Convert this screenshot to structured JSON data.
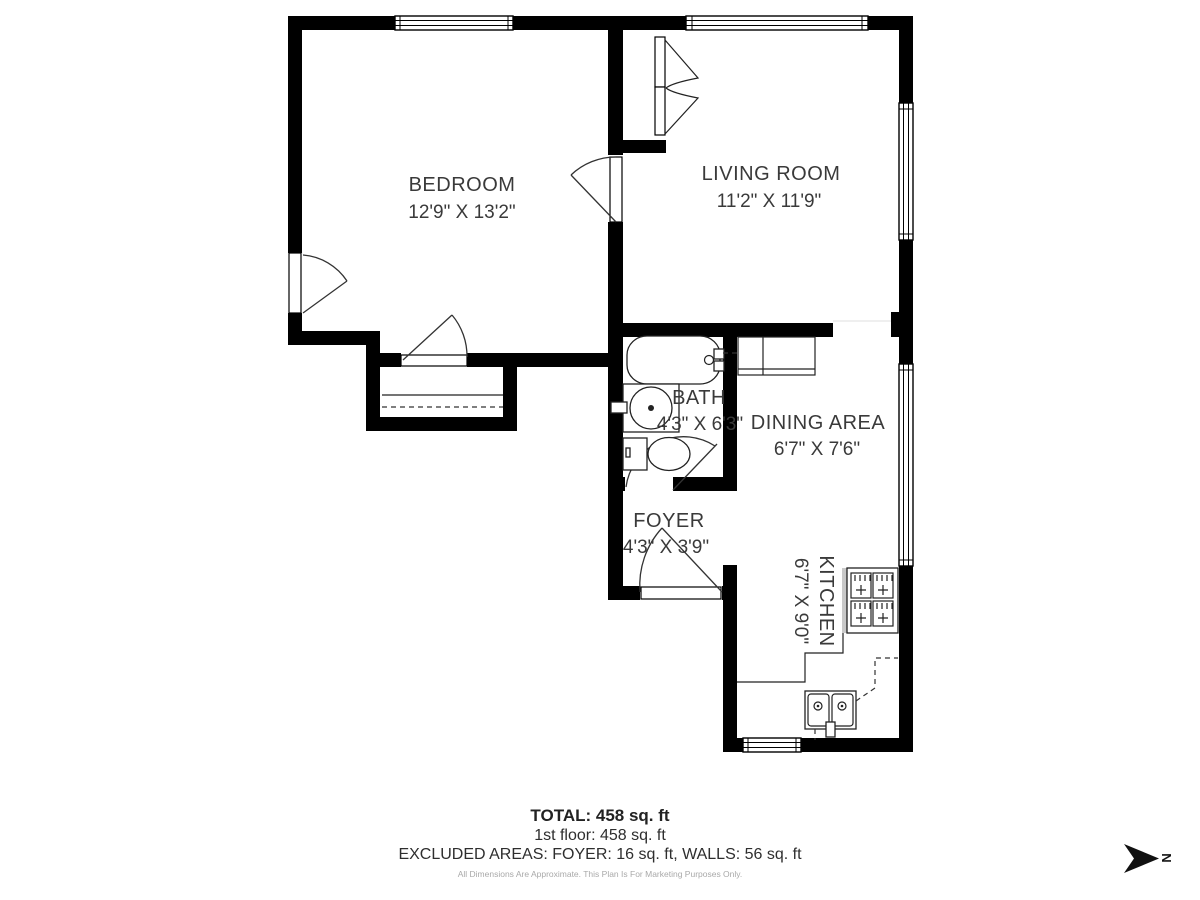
{
  "plan": {
    "rooms": {
      "bedroom": {
        "name": "BEDROOM",
        "dims": "12'9\" X 13'2\""
      },
      "living_room": {
        "name": "LIVING ROOM",
        "dims": "11'2\" X 11'9\""
      },
      "bath": {
        "name": "BATH",
        "dims": "4'3\" X 6'3\""
      },
      "dining": {
        "name": "DINING AREA",
        "dims": "6'7\" X 7'6\""
      },
      "foyer": {
        "name": "FOYER",
        "dims": "4'3\" X 3'9\""
      },
      "kitchen": {
        "name": "KITCHEN",
        "dims": "6'7\" X 9'0\""
      }
    },
    "north_label": "N"
  },
  "summary": {
    "total": "TOTAL: 458 sq. ft",
    "first_floor": "1st floor: 458 sq. ft",
    "excluded": "EXCLUDED AREAS: FOYER: 16 sq. ft, WALLS: 56 sq. ft",
    "disclaimer": "All Dimensions Are Approximate. This Plan Is For Marketing Purposes Only."
  },
  "colors": {
    "wall": "#000000",
    "label": "#3a3a3a",
    "disclaimer_text": "#a9a9a9"
  }
}
